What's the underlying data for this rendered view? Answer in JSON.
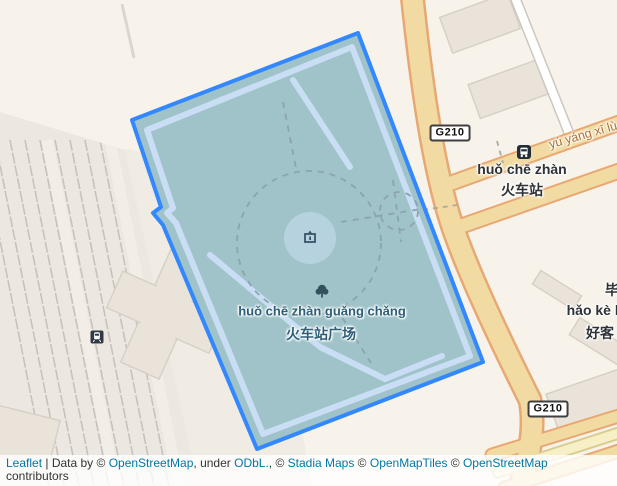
{
  "map": {
    "labels": {
      "street_name": "yú yáng xī lù",
      "station_pinyin": "huǒ chē zhàn",
      "station_cjk": "火车站",
      "plaza_pinyin": "huǒ chē zhàn guǎng chǎng",
      "plaza_cjk": "火车站广场",
      "partial_label_top": "毕",
      "partial_label_pinyin": "hǎo kè b",
      "partial_label_cjk": "好客"
    },
    "badges": {
      "route_top": "G210",
      "route_bottom": "G210"
    },
    "colors": {
      "selection_border": "#3388ff",
      "selection_fill": "#9fc3c8",
      "inner_path": "#c9def4",
      "road_fill": "#f1dba2",
      "road_casing": "#e8a874",
      "background": "#f8f3ea",
      "link": "#0078a8"
    }
  },
  "attribution": {
    "segments": [
      {
        "text": "Leaflet"
      },
      {
        "text": " | Data by © "
      },
      {
        "text": "OpenStreetMap"
      },
      {
        "text": ", under "
      },
      {
        "text": "ODbL."
      },
      {
        "text": ", © "
      },
      {
        "text": "Stadia Maps"
      },
      {
        "text": " © "
      },
      {
        "text": "OpenMapTiles"
      },
      {
        "text": " © "
      },
      {
        "text": "OpenStreetMap"
      },
      {
        "text": " contributors"
      }
    ]
  }
}
